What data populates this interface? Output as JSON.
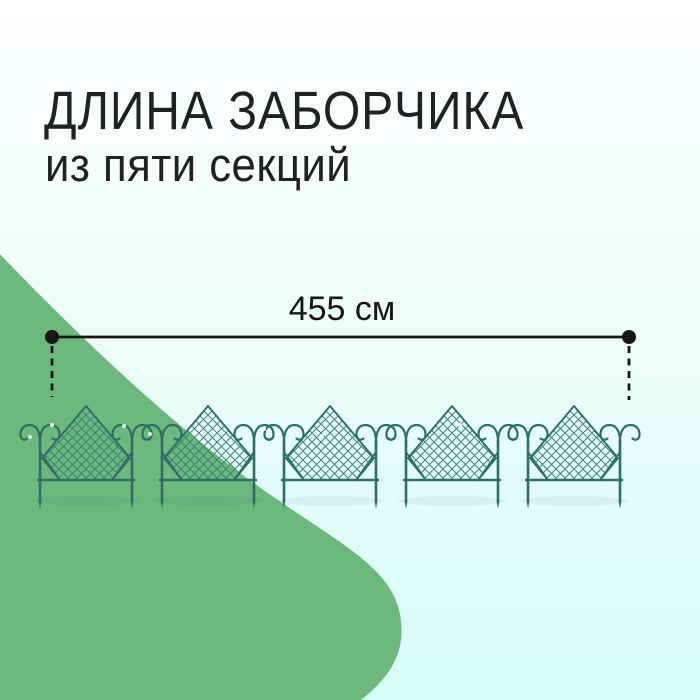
{
  "page": {
    "kind": "product-dimension-infographic",
    "language": "ru"
  },
  "title": {
    "line1": "ДЛИНА ЗАБОРЧИКА",
    "line2": "из пяти секций"
  },
  "dimension": {
    "label": "455 см",
    "value_cm": 455
  },
  "fence": {
    "sections": 5,
    "style": "diamond-lattice-with-scroll-curls"
  },
  "colors": {
    "background_top": "#FEFFFF",
    "background_bottom": "#D6FCF5",
    "blob_green": "#6CB87E",
    "fence_teal": "#2E6F63",
    "fence_mesh": "#3E8174",
    "dimension_black": "#161616",
    "text_black": "#1D2320",
    "highlight_white": "#FFFFFF"
  }
}
